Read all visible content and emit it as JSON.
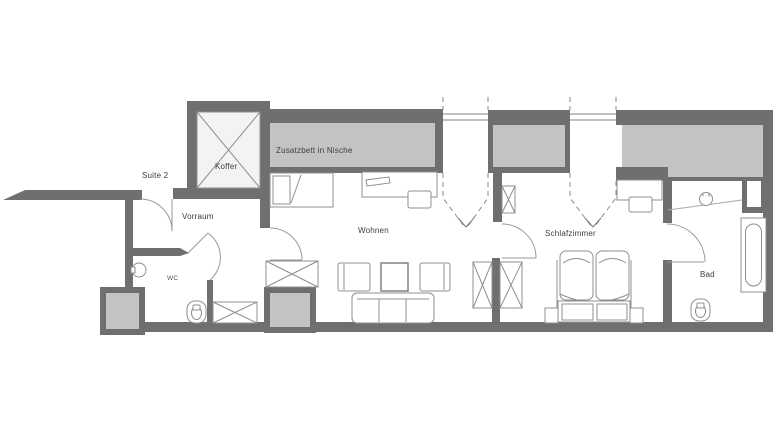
{
  "plan": {
    "suite_label": "Suite 2",
    "rooms": {
      "koffer": {
        "label": "Koffer"
      },
      "vorraum": {
        "label": "Vorraum"
      },
      "wc": {
        "label": "WC"
      },
      "wohnen": {
        "label": "Wohnen"
      },
      "schlafzimmer": {
        "label": "Schlafzimmer"
      },
      "bad": {
        "label": "Bad"
      }
    },
    "annotations": {
      "zusatzbett": {
        "label": "Zusatzbett in Nische"
      }
    },
    "colors": {
      "wall": "#6f6f6f",
      "mass_gray": "#c3c3c3",
      "light_fill": "#f3f3f3",
      "furniture_line": "#8f8f8f",
      "door_line": "#9a9a9a",
      "text": "#3c3c3c",
      "background": "#ffffff"
    }
  }
}
